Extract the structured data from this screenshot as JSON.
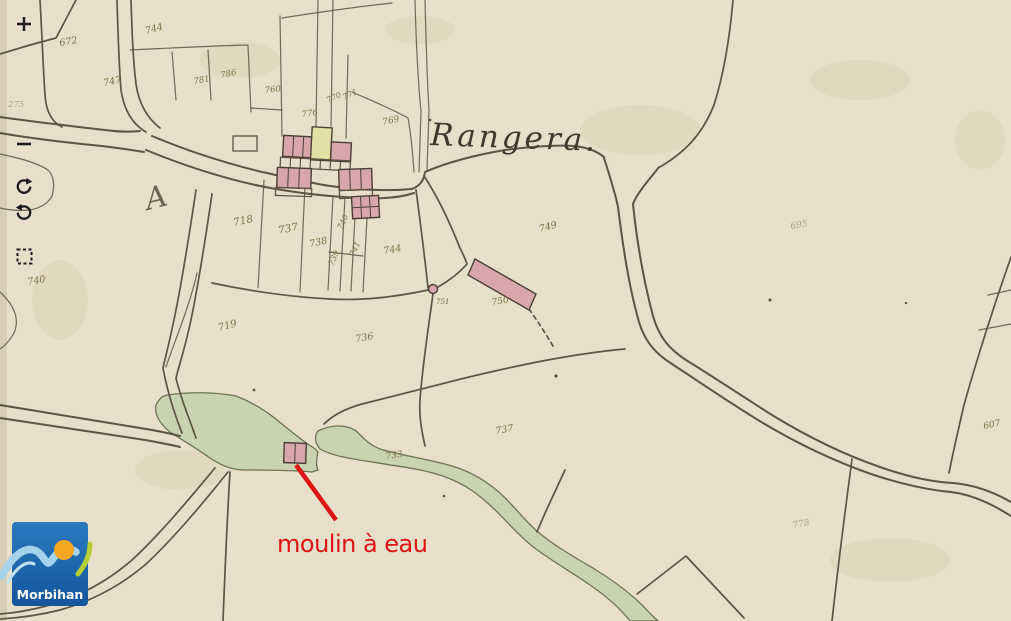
{
  "viewer": {
    "toolbar": {
      "buttons": [
        {
          "icon": "plus-icon",
          "action": "zoom-in"
        },
        {
          "icon": "minus-icon",
          "action": "zoom-out"
        },
        {
          "icon": "rotate-clockwise-icon",
          "action": "rotate-clockwise"
        },
        {
          "icon": "rotate-counterclockwise-icon",
          "action": "rotate-counterclockwise"
        },
        {
          "icon": "dashed-square-icon",
          "action": "zoom-to-extent"
        }
      ],
      "icon_color": "#1c1c1c"
    },
    "logo": {
      "text": "Morbihan",
      "colors": {
        "background": "#1c6ab3",
        "wave": "#a6d3ec",
        "sun": "#f4a71f",
        "leaf": "#b9cf36",
        "text": "#ffffff"
      }
    }
  },
  "map": {
    "place_label": "Rangera.",
    "section_letter": "A",
    "annotation": {
      "text": "moulin à eau",
      "color": "#de1414"
    },
    "colors": {
      "paper": "#e7dfca",
      "lines": "#5c5444",
      "water_green": "#c9d3b2",
      "building_pink": "#d9a6aa",
      "building_yellow": "#e4dfa4",
      "ink_numbers": "#80704a"
    },
    "parcel_numbers": [
      {
        "text": "672",
        "x": 60,
        "y": 46,
        "r": -10
      },
      {
        "text": "744",
        "x": 146,
        "y": 34,
        "r": -15
      },
      {
        "text": "747",
        "x": 104,
        "y": 86,
        "r": -12
      },
      {
        "text": "781",
        "x": 194,
        "y": 84,
        "r": -10,
        "size": 8.5
      },
      {
        "text": "786",
        "x": 221,
        "y": 78,
        "r": -12,
        "size": 8.5
      },
      {
        "text": "760",
        "x": 265,
        "y": 93,
        "r": -6,
        "size": 8.5
      },
      {
        "text": "275",
        "x": 8,
        "y": 107,
        "r": 0,
        "size": 8.5,
        "faint": true
      },
      {
        "text": "776",
        "x": 302,
        "y": 117,
        "r": -8,
        "size": 8.5
      },
      {
        "text": "770",
        "x": 328,
        "y": 103,
        "r": -25,
        "size": 8
      },
      {
        "text": "771",
        "x": 344,
        "y": 100,
        "r": -25,
        "size": 8
      },
      {
        "text": "769",
        "x": 383,
        "y": 125,
        "r": -12,
        "size": 9
      },
      {
        "text": "749",
        "x": 540,
        "y": 232,
        "r": -15
      },
      {
        "text": "750",
        "x": 492,
        "y": 305,
        "r": -8,
        "size": 9
      },
      {
        "text": "751",
        "x": 436,
        "y": 304,
        "r": 0,
        "size": 7
      },
      {
        "text": "718",
        "x": 234,
        "y": 226,
        "r": -12,
        "size": 10.5
      },
      {
        "text": "737",
        "x": 279,
        "y": 234,
        "r": -12,
        "size": 10.5
      },
      {
        "text": "738",
        "x": 310,
        "y": 247,
        "r": -12,
        "size": 9.5
      },
      {
        "text": "740",
        "x": 342,
        "y": 230,
        "r": -65,
        "size": 8
      },
      {
        "text": "741",
        "x": 354,
        "y": 257,
        "r": -65,
        "size": 8
      },
      {
        "text": "739",
        "x": 333,
        "y": 266,
        "r": -65,
        "size": 8
      },
      {
        "text": "744",
        "x": 384,
        "y": 254,
        "r": -10,
        "size": 9.5
      },
      {
        "text": "740",
        "x": 28,
        "y": 285,
        "r": -10
      },
      {
        "text": "719",
        "x": 219,
        "y": 331,
        "r": -15,
        "size": 10
      },
      {
        "text": "736",
        "x": 356,
        "y": 342,
        "r": -10
      },
      {
        "text": "737",
        "x": 496,
        "y": 434,
        "r": -10
      },
      {
        "text": "733",
        "x": 386,
        "y": 459,
        "r": -8,
        "size": 9
      },
      {
        "text": "695",
        "x": 791,
        "y": 229,
        "r": -10,
        "size": 9,
        "faint": true
      },
      {
        "text": "607",
        "x": 984,
        "y": 429,
        "r": -12,
        "size": 9
      },
      {
        "text": "778",
        "x": 793,
        "y": 528,
        "r": -10,
        "size": 9,
        "faint": true
      }
    ]
  }
}
